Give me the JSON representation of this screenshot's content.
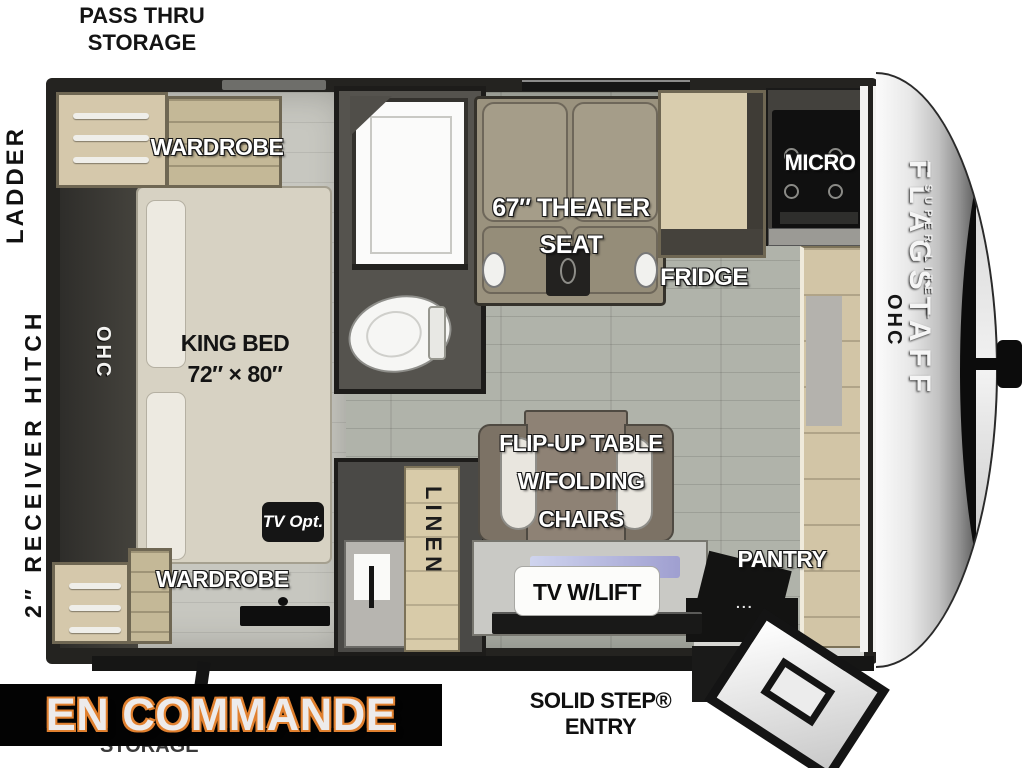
{
  "banner": {
    "text": "EN COMMANDE",
    "bg_color": "#030303",
    "text_color": "#edebeb",
    "outline_color": "#e0802f"
  },
  "exterior": {
    "pass_thru_line1": "PASS THRU",
    "pass_thru_line2": "STORAGE",
    "ladder": "LADDER",
    "receiver_hitch": "2″ RECEIVER HITCH",
    "solid_step_entry": "SOLID STEP® ENTRY",
    "storage_partial": "STORAGE"
  },
  "bedroom": {
    "wardrobe_top": "WARDROBE",
    "wardrobe_bottom": "WARDROBE",
    "bed_line1": "KING BED",
    "bed_line2": "72″ × 80″",
    "ohc_rear": "OHC",
    "tv_opt": "TV Opt."
  },
  "bath_hall": {
    "linen": "LINEN"
  },
  "living": {
    "theater_line1": "67″ THEATER",
    "theater_line2": "SEAT",
    "fridge": "FRIDGE",
    "micro": "MICRO",
    "table_line1": "FLIP-UP TABLE",
    "table_line2": "W/FOLDING",
    "table_line3": "CHAIRS",
    "tv_lift": "TV W/LIFT",
    "pantry": "PANTRY",
    "pantry_handle": "...",
    "ohc_front": "OHC"
  },
  "brand": {
    "name": "FLAGSTAFF",
    "subtitle": "— SUPER LITE —"
  },
  "colors": {
    "floor": "#b0b3aa",
    "bedroom_floor": "#c7c7c0",
    "walls": "#242320",
    "wood": "#d2c5a6",
    "seat": "#9a927e"
  }
}
